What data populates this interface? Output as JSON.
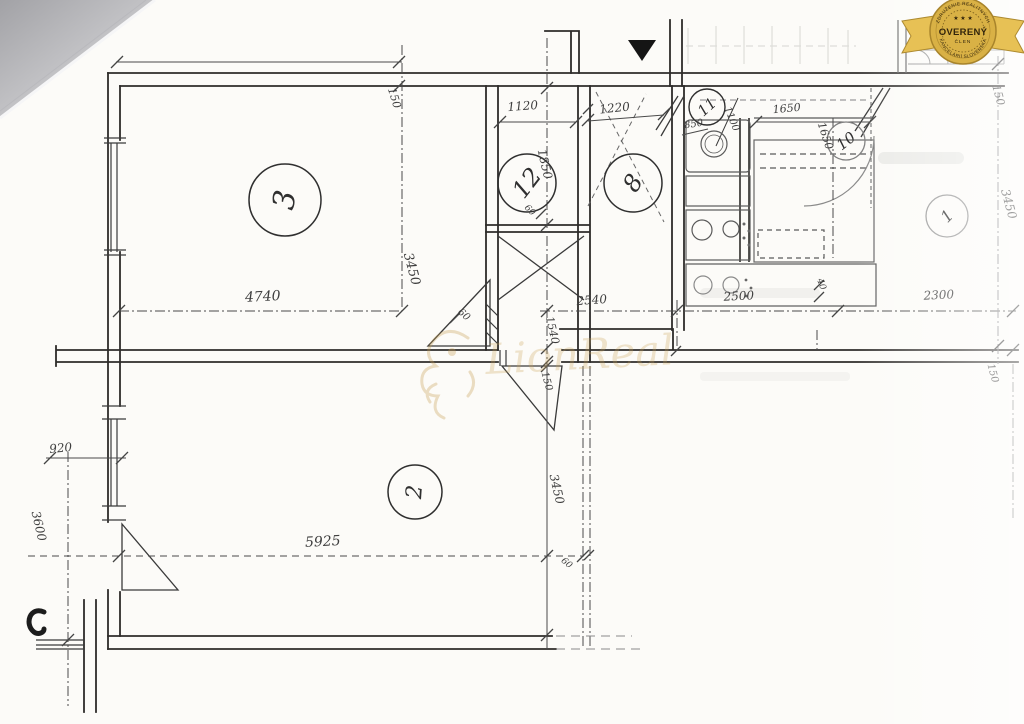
{
  "badge": {
    "label": "OVERENÝ",
    "member": "ČLEN",
    "arc_top": "ZDRUŽENIE REALITNÝCH",
    "arc_bottom": "KANCELÁRIÍ SLOVENSKA",
    "stars": "★ ★ ★",
    "colors": {
      "gold": "#D9B145",
      "gold_dark": "#A8842B",
      "ribbon": "#E7C155",
      "text": "#33250C"
    }
  },
  "watermark": {
    "text": "LionReal",
    "color": "#C79F52"
  },
  "rooms": {
    "r1": "1",
    "r2": "2",
    "r3": "3",
    "r8": "8",
    "r10": "10",
    "r11": "11",
    "r12": "12"
  },
  "dims": {
    "r3_wall_150": "150",
    "r3_width": "4740",
    "r3_height": "3450",
    "r12_width": "1120",
    "r12_height": "1850",
    "r12_gap": "60",
    "hall_width": "1220",
    "wc_850": "850",
    "wc_1100": "1100",
    "kitchen_1650_h": "1650",
    "kitchen_1650_v": "1650",
    "kitchen_40": "40",
    "r1_wall_150": "150",
    "r1_height": "3450",
    "mid_2540": "2540",
    "mid_2500": "2500",
    "mid_2300": "2300",
    "mid_1540": "1540",
    "mid_150": "150",
    "right_150": "150",
    "door_60": "60",
    "left_920": "920",
    "left_3600": "3600",
    "r2_width": "5925",
    "r2_height": "3450",
    "r2_gap": "60"
  }
}
